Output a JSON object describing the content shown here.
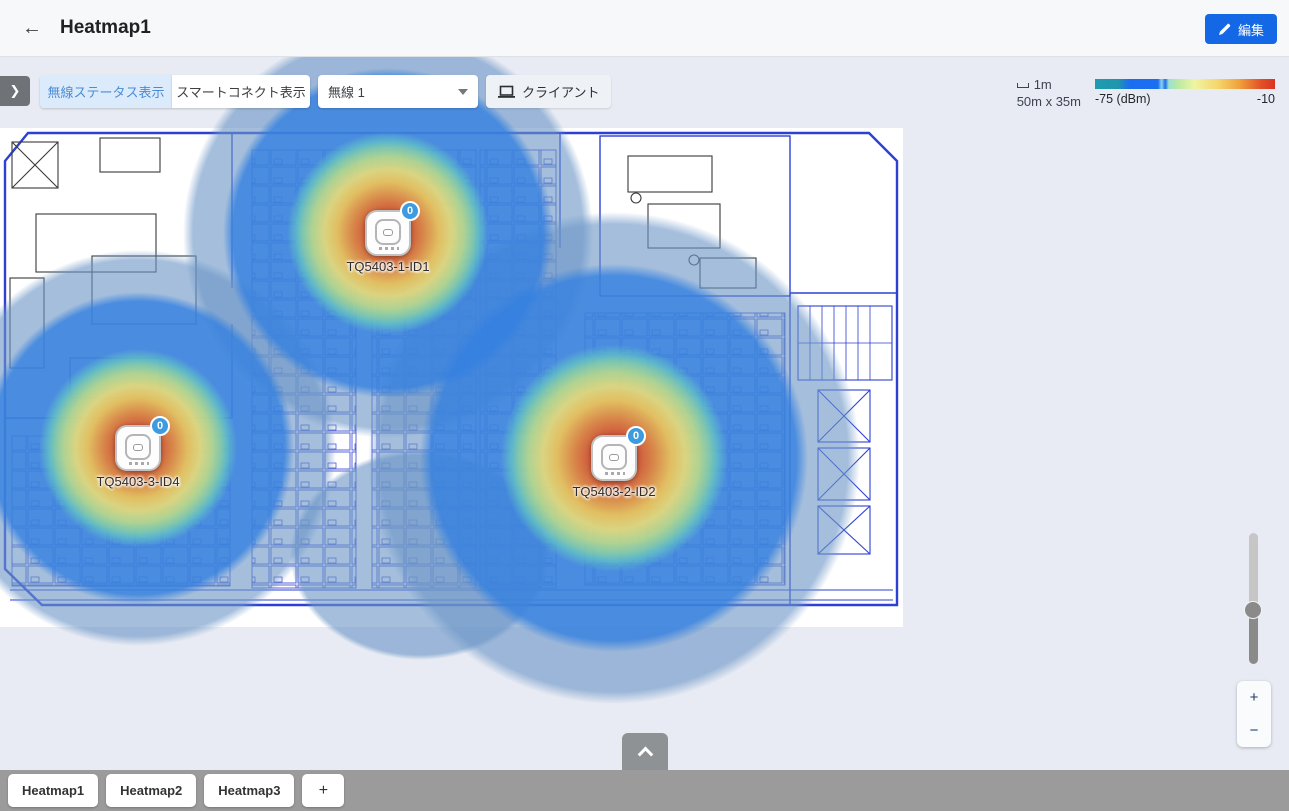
{
  "header": {
    "back_icon": "←",
    "title": "Heatmap1",
    "edit_button_label": "編集"
  },
  "toolbar": {
    "expand_icon": "❯",
    "wireless_status_button": "無線ステータス表示",
    "smart_connect_button": "スマートコネクト表示",
    "radio_dropdown": {
      "value": "無線 1"
    },
    "client_button_label": "クライアント"
  },
  "legend": {
    "scale_label": "1m",
    "map_dimensions": "50m x 35m",
    "scale_min_label": "-75 (dBm)",
    "scale_max_label": "-10",
    "gradient_colors": [
      "#1f9bb0",
      "#1b6ef0",
      "#9fe0d0",
      "#eef5a2",
      "#f6d76e",
      "#f0a23c",
      "#d93322"
    ]
  },
  "access_points": [
    {
      "name": "TQ5403-1-ID1",
      "client_count": "0"
    },
    {
      "name": "TQ5403-3-ID4",
      "client_count": "0"
    },
    {
      "name": "TQ5403-2-ID2",
      "client_count": "0"
    }
  ],
  "zoom_controls": {
    "zoom_in_label": "+",
    "zoom_out_label": "−"
  },
  "bottom": {
    "tabs": [
      "Heatmap1",
      "Heatmap2",
      "Heatmap3"
    ],
    "add_tab_label": "+"
  },
  "heat_colors": {
    "strongest": "#c63126",
    "strong": "#e78238",
    "medium": "#eede74",
    "weak": "#3480e0",
    "weakest": "#6c96c7",
    "accent_blue": "#1568e5"
  }
}
